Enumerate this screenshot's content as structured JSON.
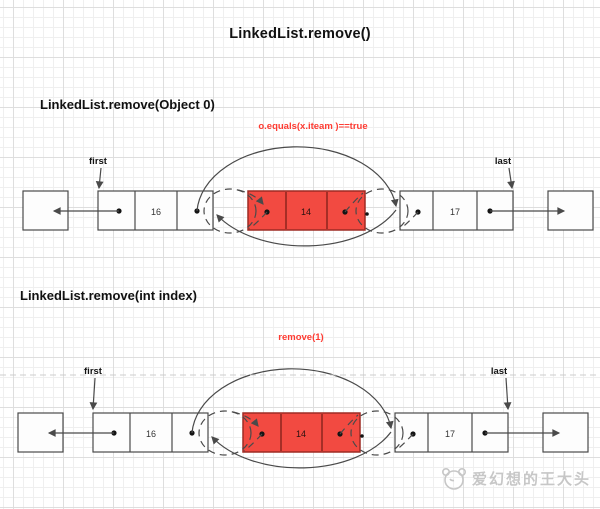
{
  "title": "LinkedList.remove()",
  "sections": [
    {
      "heading": "LinkedList.remove(Object 0)",
      "annotation": "o.equals(x.iteam )==true",
      "labels": {
        "first": "first",
        "last": "last"
      },
      "nodes": {
        "prev_value": "16",
        "removed_value": "14",
        "next_value": "17"
      }
    },
    {
      "heading": "LinkedList.remove(int index)",
      "annotation": "remove(1)",
      "labels": {
        "first": "first",
        "last": "last"
      },
      "nodes": {
        "prev_value": "16",
        "removed_value": "14",
        "next_value": "17"
      }
    }
  ],
  "watermark": {
    "text": "爱幻想的王大头"
  },
  "colors": {
    "removed_node_fill": "#f24a41",
    "removed_node_border": "#9e2b24",
    "annotation_red": "#fe3b32",
    "line": "#4a4a4a"
  }
}
